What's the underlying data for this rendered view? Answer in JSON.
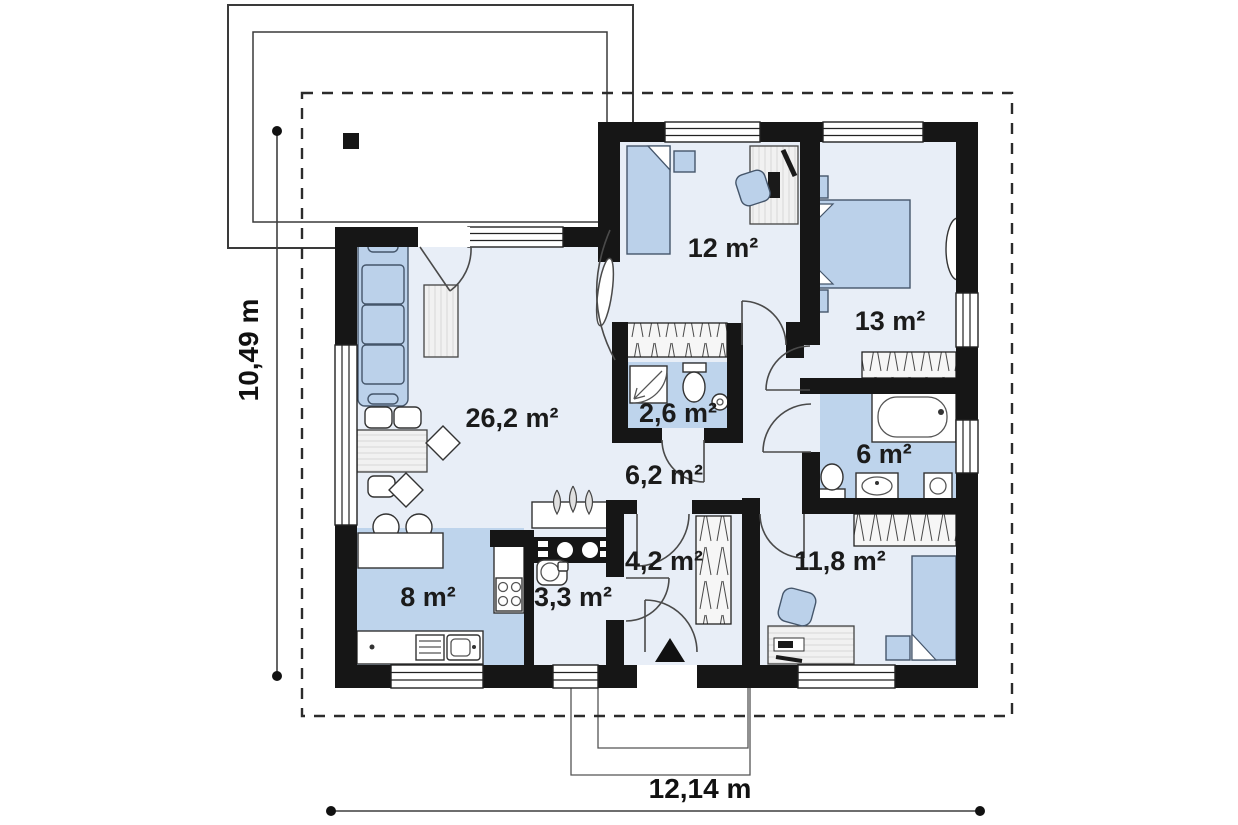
{
  "plan": {
    "type": "floor-plan",
    "rooms": [
      {
        "name": "living-room",
        "area": "26,2 m²"
      },
      {
        "name": "bedroom-top",
        "area": "12 m²"
      },
      {
        "name": "bedroom-right",
        "area": "13 m²"
      },
      {
        "name": "toilet",
        "area": "2,6 m²"
      },
      {
        "name": "hallway",
        "area": "6,2 m²"
      },
      {
        "name": "bathroom",
        "area": "6 m²"
      },
      {
        "name": "entry-hall",
        "area": "4,2 m²"
      },
      {
        "name": "bedroom-bottom",
        "area": "11,8 m²"
      },
      {
        "name": "kitchen",
        "area": "8 m²"
      },
      {
        "name": "utility",
        "area": "3,3 m²"
      }
    ],
    "dimensions": {
      "height_label": "10,49 m",
      "width_label": "12,14 m"
    },
    "colors": {
      "wall": "#161616",
      "floor": "#e8eef7",
      "wet_floor": "#bed4ec",
      "furniture": "#bbd1ea"
    }
  }
}
